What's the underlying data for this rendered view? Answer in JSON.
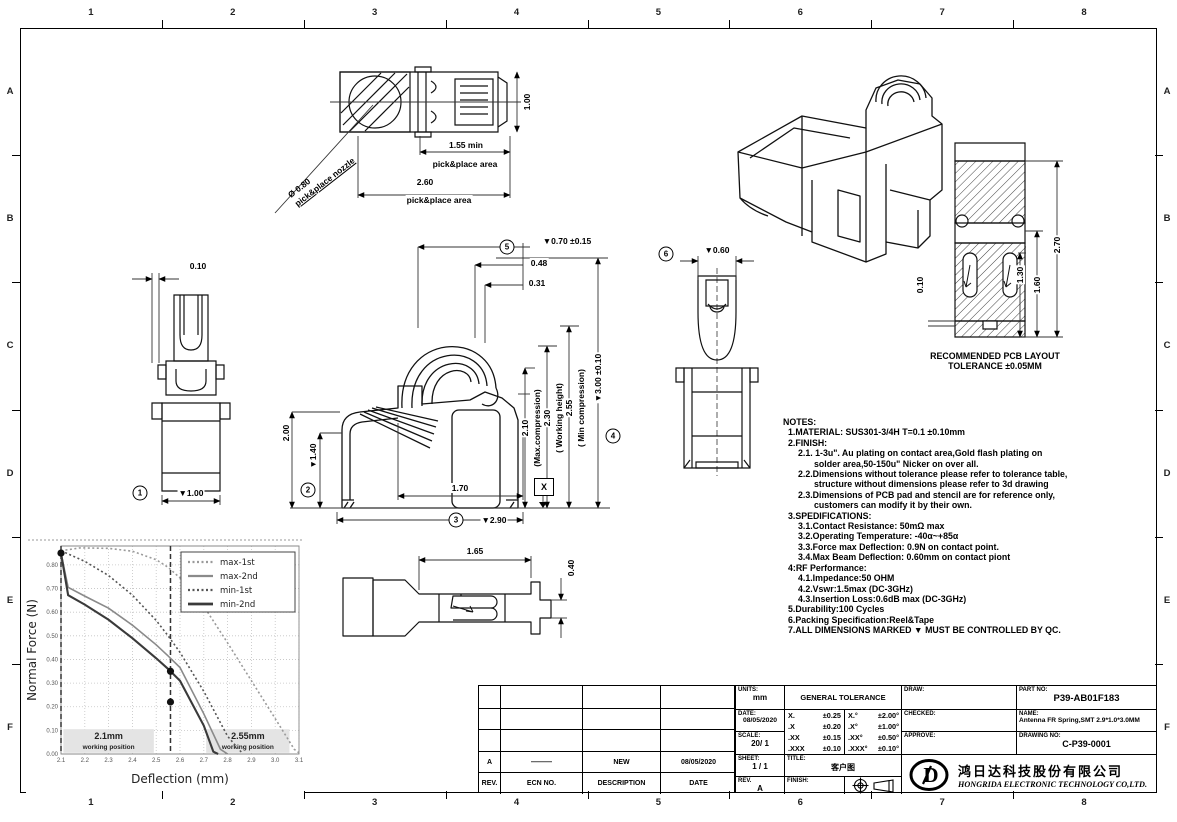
{
  "border": {
    "columns": [
      "1",
      "2",
      "3",
      "4",
      "5",
      "6",
      "7",
      "8"
    ],
    "rows": [
      "A",
      "B",
      "C",
      "D",
      "E",
      "F"
    ]
  },
  "views": {
    "top": {
      "dim_height": "1.00",
      "dim_pp1": "1.55 min",
      "dim_pp1_label": "pick&place area",
      "dim_pp2": "2.60",
      "dim_pp2_label": "pick&place area",
      "nozzle_dia": "Ø 0.80",
      "nozzle_label": "pick&place nozzle"
    },
    "side_left": {
      "dim_gap": "0.10",
      "marker": "1",
      "dim_width": "▼1.00"
    },
    "front": {
      "marker2": "2",
      "dim_h2": "2.00",
      "dim_h14": "▼1.40",
      "marker5": "5",
      "dim_top": "▼0.70 ±0.15",
      "dim_048": "0.48",
      "dim_031": "0.31",
      "dim_210": "2.10",
      "dim_210_label": "(Max.compression)",
      "dim_230": "2.30",
      "dim_230_label": "( Working height)",
      "dim_255": "2.55",
      "dim_255_label": "( Min compression)",
      "marker4": "4",
      "dim_300": "▼3.00 ±0.10",
      "dim_170": "1.70",
      "marker3": "3",
      "dim_290": "▼2.90",
      "datum": "X"
    },
    "side_right": {
      "marker6": "6",
      "dim_060": "▼0.60"
    },
    "bottom": {
      "dim_165": "1.65",
      "dim_040": "0.40"
    },
    "pcb": {
      "dim_010": "0.10",
      "dim_130": "1.30",
      "dim_160": "1.60",
      "dim_270": "2.70",
      "caption_line1": "RECOMMENDED PCB LAYOUT",
      "caption_line2": "TOLERANCE ±0.05MM"
    }
  },
  "notes": {
    "lines": [
      [
        0,
        "NOTES:"
      ],
      [
        1,
        "1.MATERIAL: SUS301-3/4H  T=0.1 ±0.10mm"
      ],
      [
        1,
        "2.FINISH:"
      ],
      [
        2,
        "2.1. 1-3u\". Au plating on contact area,Gold flash plating on"
      ],
      [
        3,
        "solder area,50-150u\" Nicker on over all."
      ],
      [
        2,
        "2.2.Dimensions without tolerance please refer to tolerance table,"
      ],
      [
        3,
        "structure without dimensions please refer to 3d drawing"
      ],
      [
        2,
        "2.3.Dimensions of PCB pad and stencil are for reference only,"
      ],
      [
        3,
        "customers can modify it by their own."
      ],
      [
        1,
        "3.SPEDIFICATIONS:"
      ],
      [
        2,
        "3.1.Contact Resistance: 50mΩ max"
      ],
      [
        2,
        "3.2.Operating Temperature: -40α~+85α"
      ],
      [
        2,
        "3.3.Force max Deflection: 0.9N on contact point."
      ],
      [
        2,
        "3.4.Max Beam Deflection: 0.60mm on contact piont"
      ],
      [
        1,
        "4:RF Performance:"
      ],
      [
        2,
        "4.1.Impedance:50 OHM"
      ],
      [
        2,
        "4.2.Vswr:1.5max (DC-3GHz)"
      ],
      [
        2,
        "4.3.Insertion Loss:0.6dB max (DC-3GHz)"
      ],
      [
        1,
        "5.Durability:100 Cycles"
      ],
      [
        1,
        "6.Packing Specification:Reel&Tape"
      ],
      [
        1,
        "7.ALL DIMENSIONS MARKED ▼ MUST BE CONTROLLED BY QC."
      ]
    ]
  },
  "chart_data": {
    "type": "line",
    "xlabel": "Deflection (mm)",
    "ylabel": "Normal Force (N)",
    "xlim": [
      2.1,
      3.1
    ],
    "ylim": [
      0,
      0.88
    ],
    "xticks": [
      2.1,
      2.2,
      2.3,
      2.4,
      2.5,
      2.6,
      2.7,
      2.8,
      2.9,
      3.0,
      3.1
    ],
    "yticks": [
      0.0,
      0.1,
      0.2,
      0.3,
      0.4,
      0.5,
      0.6,
      0.7,
      0.8
    ],
    "grid": true,
    "legend_position": "top-right",
    "series": [
      {
        "name": "max-1st",
        "style": "dotted",
        "color": "#9a9a9a",
        "width": 1.6,
        "points": [
          [
            2.1,
            0.86
          ],
          [
            2.18,
            0.872
          ],
          [
            2.3,
            0.87
          ],
          [
            2.4,
            0.858
          ],
          [
            2.5,
            0.822
          ],
          [
            2.55,
            0.79
          ],
          [
            2.6,
            0.745
          ],
          [
            2.7,
            0.625
          ],
          [
            2.8,
            0.47
          ],
          [
            2.9,
            0.31
          ],
          [
            3.0,
            0.15
          ],
          [
            3.08,
            0.02
          ],
          [
            3.1,
            0.005
          ]
        ]
      },
      {
        "name": "max-2nd",
        "style": "solid",
        "color": "#8a8a8a",
        "width": 1.6,
        "points": [
          [
            2.1,
            0.85
          ],
          [
            2.13,
            0.705
          ],
          [
            2.2,
            0.668
          ],
          [
            2.3,
            0.617
          ],
          [
            2.4,
            0.545
          ],
          [
            2.5,
            0.462
          ],
          [
            2.55,
            0.415
          ],
          [
            2.6,
            0.366
          ],
          [
            2.7,
            0.17
          ],
          [
            2.77,
            0.02
          ],
          [
            2.8,
            0.0
          ]
        ]
      },
      {
        "name": "min-1st",
        "style": "dotted",
        "color": "#555555",
        "width": 1.6,
        "points": [
          [
            2.1,
            0.86
          ],
          [
            2.2,
            0.815
          ],
          [
            2.3,
            0.755
          ],
          [
            2.4,
            0.672
          ],
          [
            2.5,
            0.565
          ],
          [
            2.55,
            0.5
          ],
          [
            2.6,
            0.43
          ],
          [
            2.7,
            0.265
          ],
          [
            2.8,
            0.075
          ],
          [
            2.86,
            0.005
          ]
        ]
      },
      {
        "name": "min-2nd",
        "style": "solid",
        "color": "#3a3a3a",
        "width": 2.1,
        "points": [
          [
            2.1,
            0.85
          ],
          [
            2.13,
            0.672
          ],
          [
            2.2,
            0.632
          ],
          [
            2.3,
            0.568
          ],
          [
            2.4,
            0.49
          ],
          [
            2.5,
            0.405
          ],
          [
            2.55,
            0.36
          ],
          [
            2.6,
            0.31
          ],
          [
            2.7,
            0.12
          ],
          [
            2.74,
            0.01
          ],
          [
            2.76,
            0.0
          ]
        ]
      }
    ],
    "markers": [
      [
        2.1,
        0.85
      ],
      [
        2.56,
        0.35
      ],
      [
        2.56,
        0.22
      ]
    ],
    "vlines": [
      2.1,
      2.56
    ],
    "regions": [
      {
        "label": "2.1mm",
        "sublabel": "working position",
        "x1": 2.11,
        "x2": 2.49,
        "y1": 0.005,
        "y2": 0.105
      },
      {
        "label": "2.55mm",
        "sublabel": "working position",
        "x1": 2.71,
        "x2": 3.06,
        "y1": 0.005,
        "y2": 0.105
      }
    ]
  },
  "revision_table": {
    "headers": [
      "REV.",
      "ECN NO.",
      "DESCRIPTION",
      "DATE"
    ],
    "empty_rows": 3,
    "rows": [
      [
        "A",
        "———",
        "NEW",
        "08/05/2020"
      ]
    ]
  },
  "title_block": {
    "units_label": "UNITS:",
    "units": "mm",
    "date_label": "DATE:",
    "date": "08/05/2020",
    "scale_label": "SCALE:",
    "scale": "20/ 1",
    "sheet_label": "SHEET:",
    "sheet": "1 / 1",
    "rev_label": "REV.",
    "rev": "A",
    "tolerance_header": "GENERAL TOLERANCE",
    "tolerance_rows": [
      [
        "X.",
        "±0.25",
        "X.°",
        "±2.00°"
      ],
      [
        ".X",
        "±0.20",
        ".X°",
        "±1.00°"
      ],
      [
        ".XX",
        "±0.15",
        ".XX°",
        "±0.50°"
      ],
      [
        ".XXX",
        "±0.10",
        ".XXX°",
        "±0.10°"
      ]
    ],
    "title_label": "TITLE:",
    "title": "客户图",
    "finish_label": "FINISH:",
    "draw_label": "DRAW:",
    "checked_label": "CHECKED:",
    "approve_label": "APPROVE:",
    "part_no_label": "PART NO:",
    "part_no": "P39-AB01F183",
    "name_label": "NAME:",
    "name": "Antenna FR Spring,SMT 2.9*1.0*3.0MM",
    "drawing_no_label": "DRAWING NO:",
    "drawing_no": "C-P39-0001",
    "company_cn": "鸿日达科技股份有限公司",
    "company_en": "HONGRIDA ELECTRONIC TECHNOLOGY CO,LTD."
  }
}
